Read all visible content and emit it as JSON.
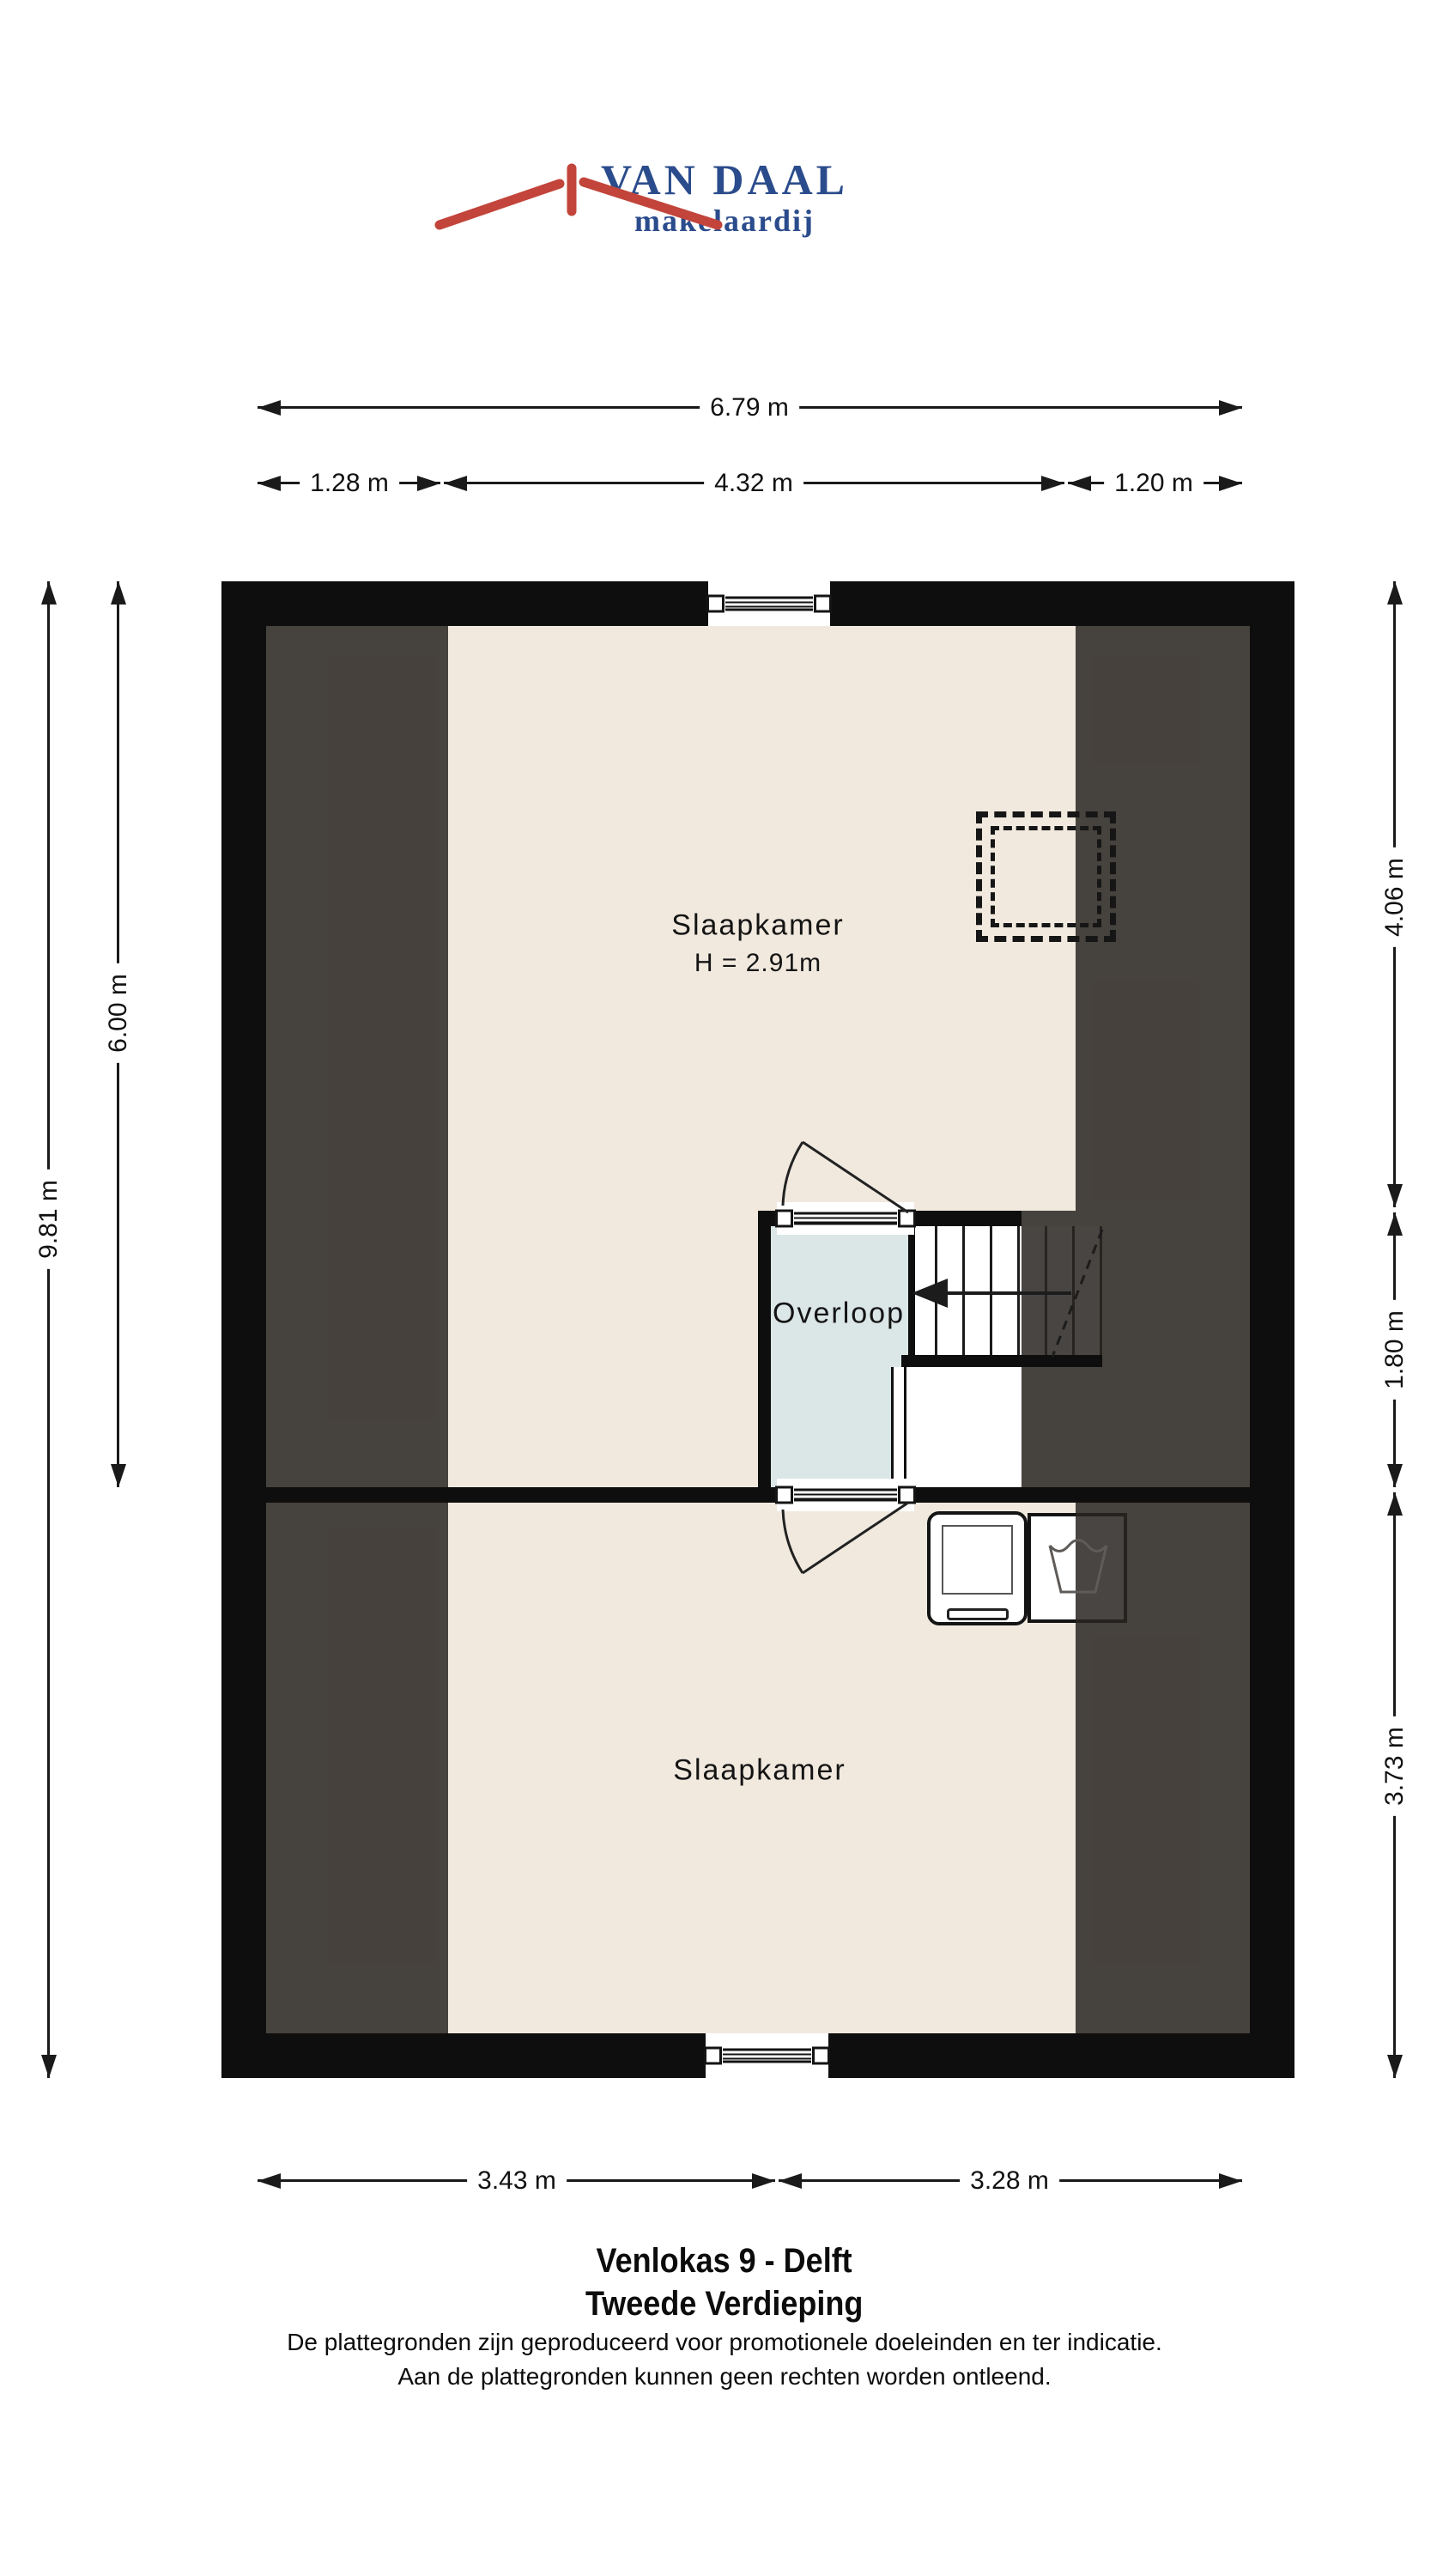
{
  "logo": {
    "name": "VAN DAAL",
    "subtitle": "makelaardij"
  },
  "dimensions": {
    "top_total": "6.79 m",
    "top_left": "1.28 m",
    "top_center": "4.32 m",
    "top_right": "1.20 m",
    "side_left_total": "9.81 m",
    "side_left_upper": "6.00 m",
    "side_right_top": "4.06 m",
    "side_right_middle": "1.80 m",
    "side_right_bottom": "3.73 m",
    "bottom_left": "3.43 m",
    "bottom_right": "3.28 m"
  },
  "rooms": {
    "bedroom_top": {
      "label": "Slaapkamer",
      "ceiling_height": "H = 2.91m"
    },
    "landing": {
      "label": "Overloop"
    },
    "bedroom_bottom": {
      "label": "Slaapkamer"
    }
  },
  "footer": {
    "address": "Venlokas 9 - Delft",
    "floor": "Tweede Verdieping",
    "disclaimer_line1": "De plattegronden zijn geproduceerd voor promotionele doeleinden en ter indicatie.",
    "disclaimer_line2": "Aan de plattegronden kunnen geen rechten worden ontleend."
  },
  "colors": {
    "wall": "#0e0e0e",
    "floor": "#f1e9de",
    "landing": "#dbe6e6",
    "dimension": "#1a1a1a",
    "logo_red": "#c2443a",
    "logo_blue": "#2b4c8c"
  }
}
